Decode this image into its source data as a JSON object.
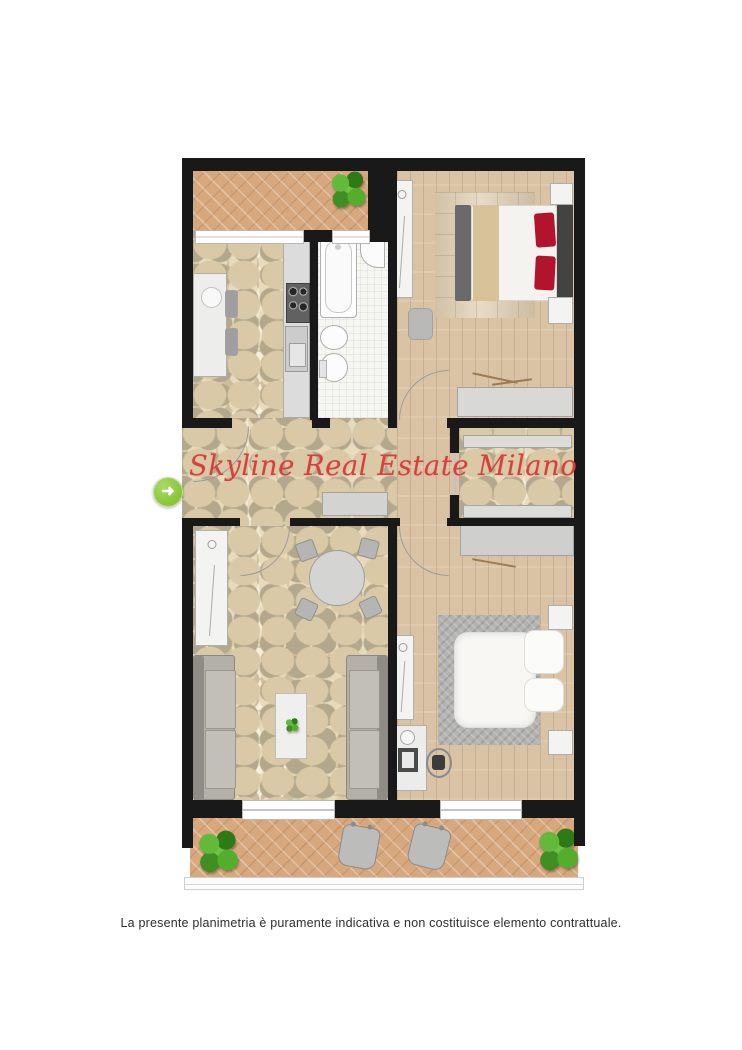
{
  "watermark": {
    "text": "Skyline Real Estate Milano",
    "color": "#d84040"
  },
  "disclaimer": {
    "text": "La presente planimetria è puramente indicativa e non costituisce elemento contrattuale.",
    "color": "#2e2e2e"
  },
  "gallery_arrow": {
    "glyph": "➜",
    "color": "#79bb22"
  },
  "palette": {
    "wall": "#191919",
    "terracotta_tile": "#d7a87e",
    "stone_mosaic": "#efe7d3",
    "wood_parquet": "#d9c3a4",
    "bath_tile": "#f6f6f2",
    "furniture_gray": "#cfcfcd",
    "sofa_gray": "#b3afa9",
    "bed_white": "#f7f6f3",
    "pillow_red": "#b2142e",
    "plant_green": "#4ea22a",
    "window_white": "#ffffff"
  }
}
